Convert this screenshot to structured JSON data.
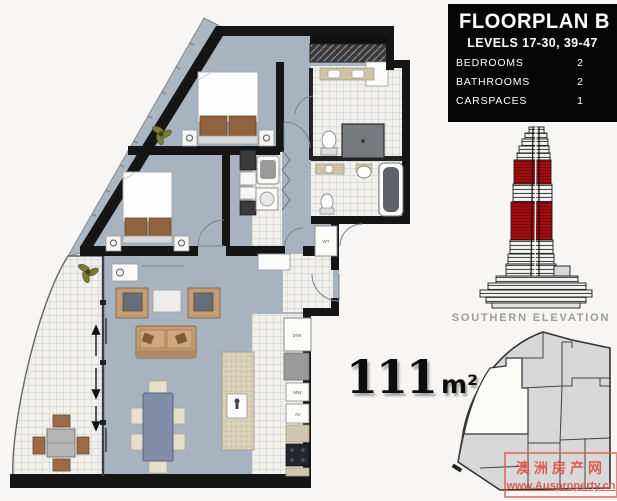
{
  "info_box": {
    "title": "FLOORPLAN B",
    "subtitle": "LEVELS 17-30, 39-47",
    "specs": [
      {
        "label": "BEDROOMS",
        "value": "2"
      },
      {
        "label": "BATHROOMS",
        "value": "2"
      },
      {
        "label": "CARSPACES",
        "value": "1"
      }
    ]
  },
  "area_label": {
    "value": "111",
    "unit": "m²"
  },
  "elevation": {
    "caption": "SOUTHERN ELEVATION"
  },
  "floorplan": {
    "appliance_labels": {
      "wt": "WT",
      "dw": "D/W",
      "mw": "MW",
      "av": "AV"
    }
  },
  "watermark": {
    "line1": "澳洲房产网",
    "line2": "www.Ausproperty.cn"
  },
  "colors": {
    "floor": "#a7b4bf",
    "wall": "#151515",
    "tower_highlight": "#a30d10",
    "caption_gray": "#9b9b9b",
    "watermark_red": "#dc5347",
    "info_bg": "#050505",
    "info_fg": "#ffffff"
  }
}
